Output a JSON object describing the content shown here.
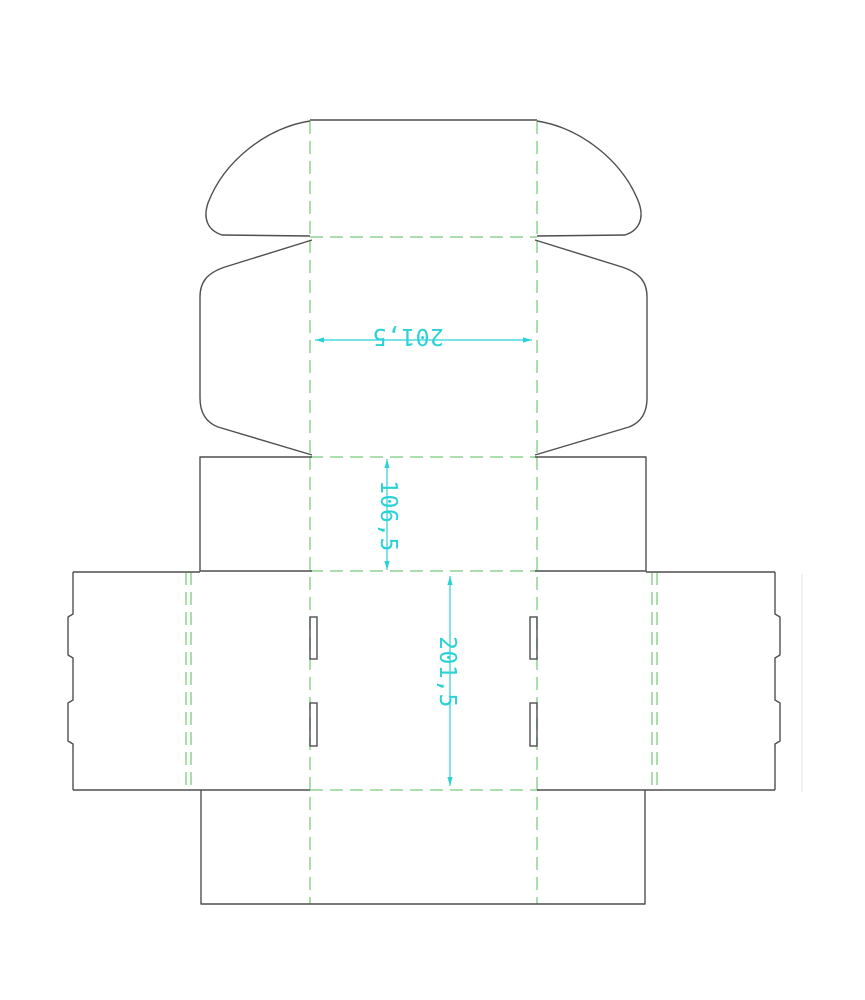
{
  "page": {
    "kind": "packaging-dieline-drawing",
    "description": "Unfolded tuck-top mailer box cutting template",
    "width": 865,
    "height": 1000,
    "background": "#ffffff"
  },
  "colors": {
    "cut": "#4f4f4f",
    "fold": "#8fd492",
    "dimension": "#2bd2d5",
    "artifact": "#e3e3e3"
  },
  "dieline": {
    "fold_dash": "13 7",
    "cut_stroke_width": 1.4,
    "fold_stroke_width": 1.5,
    "cut_paths": [
      "M310,120 L537,120",
      "M310,121 C266,128 224,161 208,203 C203,218 207,230 222,235 L310,236",
      "M537,121 C581,128 623,161 639,203 C644,218 640,230 625,235 L537,236",
      "M312,240 L225,267 C207,273 200,282 200,297 L200,398 C200,412 205,422 218,427 L312,455",
      "M535,240 L622,267 C640,273 647,282 647,297 L647,398 C647,412 642,422 629,427 L535,455",
      "M312,457 L200,457 L200,571 L312,571",
      "M535,457 L646,457 L646,571 L535,571",
      "M73,572 L200,572",
      "M646,572 L775,572",
      "M73,572 L73,614 L68,617 L68,655 L73,658 L73,700 L68,703 L68,741 L73,744 L73,790",
      "M775,572 L775,614 L780,617 L780,655 L775,658 L775,700 L780,703 L780,741 L775,744 L775,790",
      "M73,790 L310,790",
      "M537,790 L775,790",
      "M201,790 L201,904 L645,904 L645,790"
    ],
    "fold_lines": [
      {
        "x1": 310,
        "y1": 121,
        "x2": 310,
        "y2": 236
      },
      {
        "x1": 537,
        "y1": 121,
        "x2": 537,
        "y2": 236
      },
      {
        "x1": 310,
        "y1": 240,
        "x2": 310,
        "y2": 455
      },
      {
        "x1": 537,
        "y1": 240,
        "x2": 537,
        "y2": 455
      },
      {
        "x1": 310,
        "y1": 457,
        "x2": 310,
        "y2": 904
      },
      {
        "x1": 537,
        "y1": 457,
        "x2": 537,
        "y2": 904
      },
      {
        "x1": 186,
        "y1": 572,
        "x2": 186,
        "y2": 790
      },
      {
        "x1": 191,
        "y1": 572,
        "x2": 191,
        "y2": 790
      },
      {
        "x1": 652,
        "y1": 572,
        "x2": 652,
        "y2": 790
      },
      {
        "x1": 657,
        "y1": 572,
        "x2": 657,
        "y2": 790
      },
      {
        "x1": 310,
        "y1": 237,
        "x2": 537,
        "y2": 237
      },
      {
        "x1": 310,
        "y1": 457,
        "x2": 537,
        "y2": 457
      },
      {
        "x1": 310,
        "y1": 571,
        "x2": 537,
        "y2": 571
      },
      {
        "x1": 310,
        "y1": 790,
        "x2": 537,
        "y2": 790
      }
    ],
    "slits": [
      {
        "x": 310,
        "y": 617,
        "w": 7,
        "h": 42
      },
      {
        "x": 310,
        "y": 703,
        "w": 7,
        "h": 43
      },
      {
        "x": 530,
        "y": 617,
        "w": 7,
        "h": 42
      },
      {
        "x": 530,
        "y": 703,
        "w": 7,
        "h": 43
      }
    ],
    "artifact_lines": [
      {
        "x1": 802,
        "y1": 574,
        "x2": 802,
        "y2": 792
      }
    ]
  },
  "dimensions": [
    {
      "name": "lid-width-dimension",
      "label": "201,5",
      "x1": 315,
      "y1": 340,
      "x2": 532,
      "y2": 340,
      "text_x": 408,
      "text_y": 345,
      "rotation": 180,
      "font_size": 23
    },
    {
      "name": "wall-height-dimension",
      "label": "106,5",
      "x1": 387,
      "y1": 459,
      "x2": 387,
      "y2": 570,
      "text_x": 397,
      "text_y": 516,
      "rotation": 90,
      "font_size": 23
    },
    {
      "name": "base-depth-dimension",
      "label": "201,5",
      "x1": 450,
      "y1": 576,
      "x2": 450,
      "y2": 786,
      "text_x": 456,
      "text_y": 672,
      "rotation": 90,
      "font_size": 23
    }
  ]
}
